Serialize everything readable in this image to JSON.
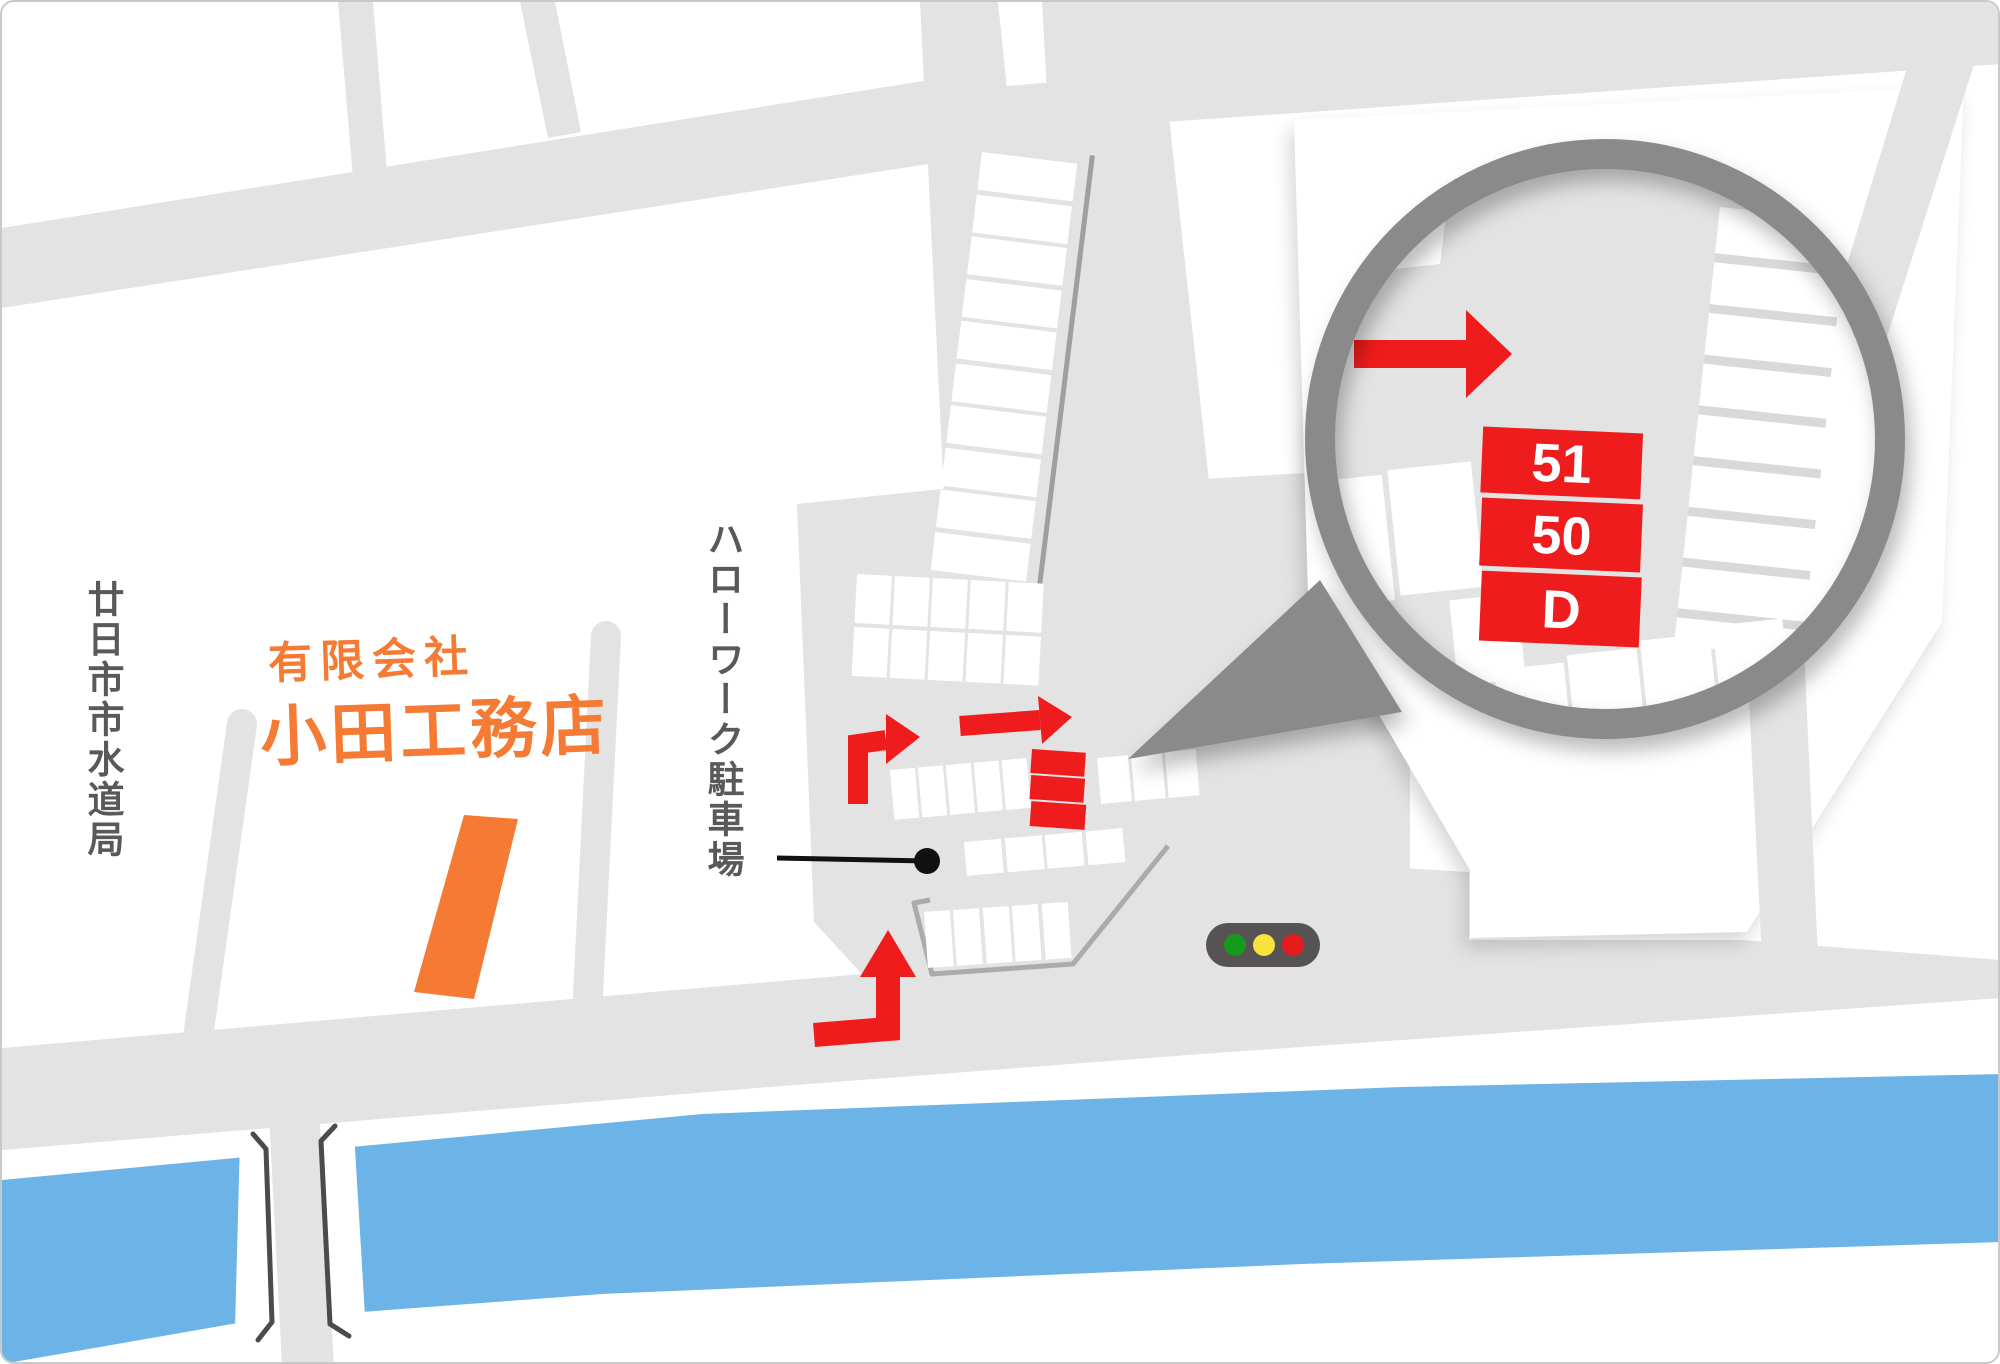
{
  "company": {
    "line1": "有限会社",
    "line2": "小田工務店"
  },
  "labels": {
    "waterworks": "廿日市市水道局",
    "parking": "ハローワーク駐車場"
  },
  "magnifier": {
    "stalls": [
      {
        "label": "51"
      },
      {
        "label": "50"
      },
      {
        "label": "D"
      }
    ]
  },
  "traffic_light": {
    "lights": [
      "green",
      "yellow",
      "red"
    ]
  },
  "colors": {
    "accent_orange": "#f57a34",
    "route_red": "#ee1c1c",
    "river_blue": "#6cb4e7",
    "road_gray": "#e3e3e3",
    "label_gray": "#595959",
    "ring_gray": "#8a8a8a"
  }
}
